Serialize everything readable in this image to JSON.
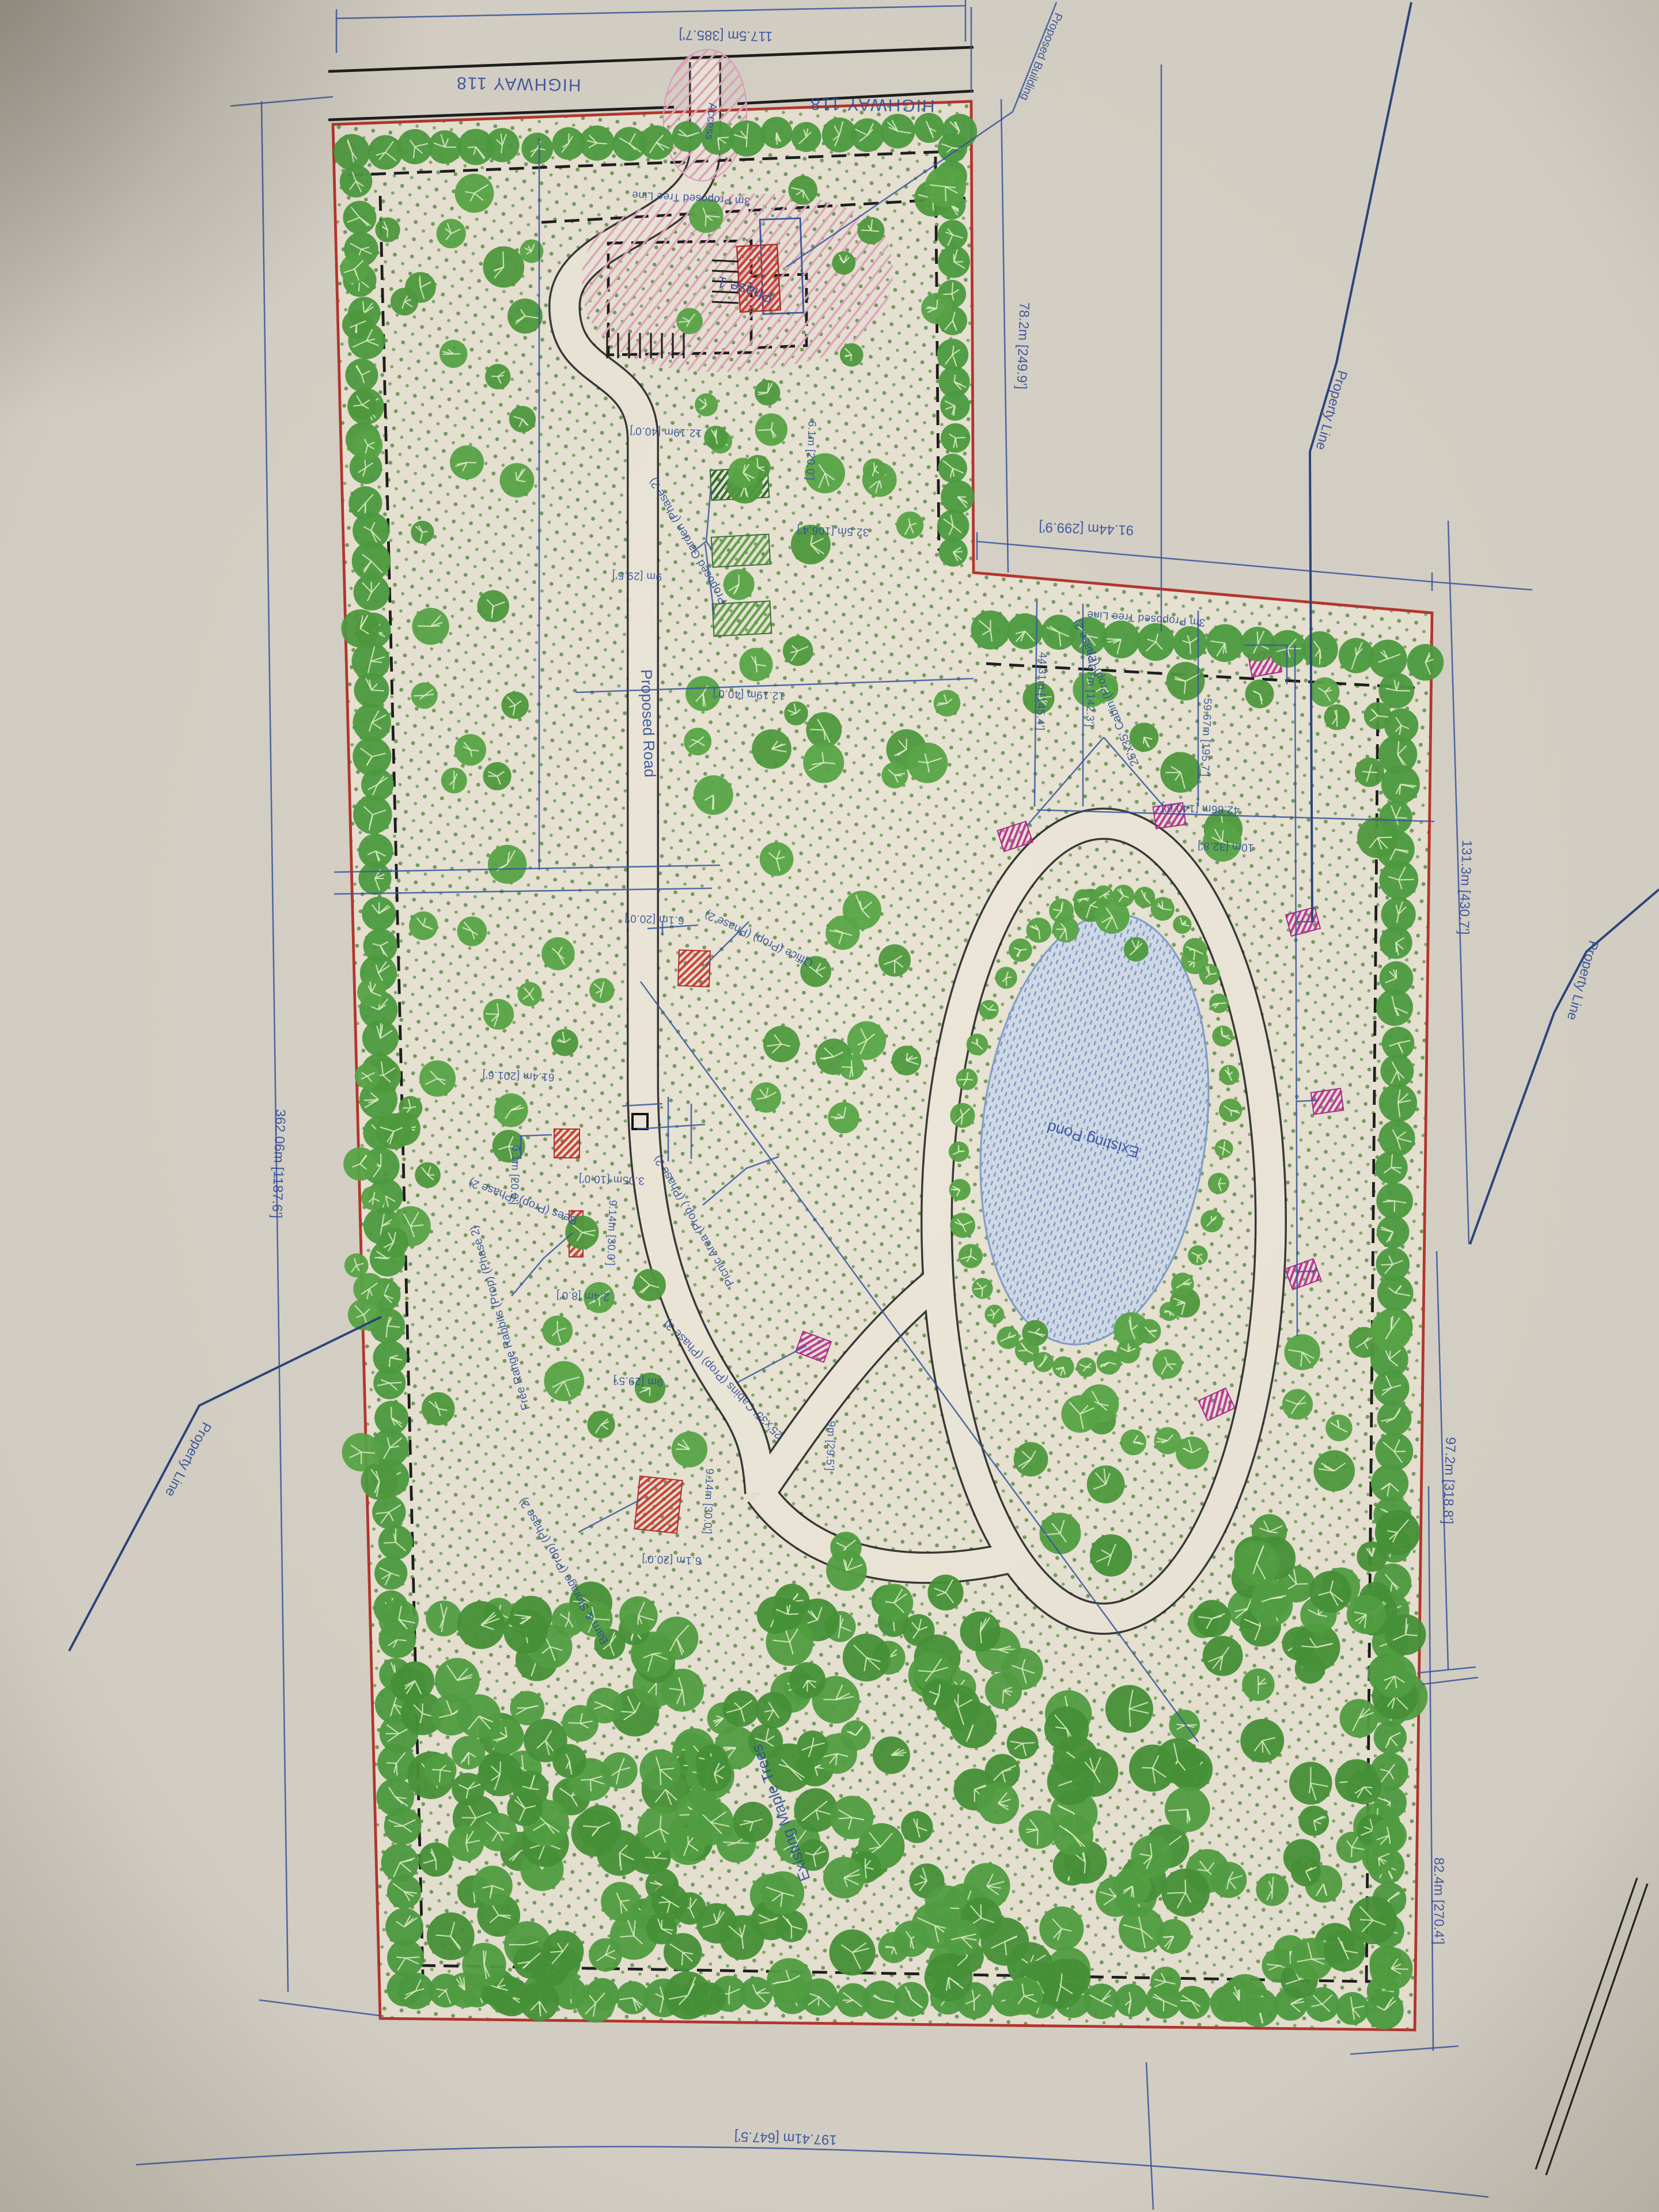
{
  "document": {
    "kind": "Photographed landscape site plan sheet",
    "orientation_note": "sheet photographed rotated 180 degrees; most annotations read upside-down"
  },
  "labels": {
    "highway": "HIGHWAY 118",
    "access": "Access",
    "phase1": "Phase 1",
    "proposed_building": "Proposed Building",
    "proposed_road": "Proposed Road",
    "existing_pond": "Existing Pond",
    "existing_maple_trees": "Existing Maple Trees",
    "property_line": "Property Line",
    "tree_line": "3m Proposed Tree Line",
    "office": "Office (Prop) (Phase 2)",
    "garden": "Proposed Garden (Phase 2)",
    "cabin_ph2": "25'x35' Cabin (Prop) (Phase 2)",
    "cabins_ph3": "25'x35' Cabins (Prop) (Phase 3)",
    "barn": "Barn & Storage (Prop) (Phase 2)",
    "bees": "Bees (Prop) (Phase 2)",
    "rabbits": "Free Range Rabbits (Prop) (Phase 2)",
    "picnic": "Picnic Area (Prop.) (Phase 2)"
  },
  "dimensions": {
    "top": "117.5m [385.7']",
    "strip_east": "78.2m [249.9']",
    "notch": "91.44m [299.9']",
    "west": "362.06m [1187.6']",
    "east_upper": "131.3m [430.7']",
    "east_mid": "97.2m [318.8']",
    "east_lower": "82.4m [270.4']",
    "south": "197.41m [647.5']",
    "d44": "44.31m [145.4']",
    "d43": "43.37m [142.3']",
    "d59": "59.67m [195.7']",
    "d42": "42.86m [140.6']",
    "d32": "32.5m [106.4']",
    "d61": "61.4m [201.6']",
    "road_w": "9m [29.5']",
    "d12": "12.19m [40.0']",
    "d9": "9.14m [30.0']",
    "d6": "6.1m [20.0']",
    "d3": "3.05m [10.0']",
    "d2": "2.4m [8.0']",
    "d10": "10m [32.8']"
  },
  "colors": {
    "paper": "#d7d2c7",
    "parcel_ground": "#e8e3d3",
    "ground_dot_green": "#5e8f4b",
    "tree_green": "#4f9a3e",
    "boundary_red": "#b5372f",
    "ink_blue": "#2e4c9b",
    "pond_blue": "#d0dae6",
    "cabin_magenta": "#c2379b",
    "building_red": "#cd4038",
    "hatch_pink": "#e2a2bf",
    "garden_green": "#2f6c2f"
  }
}
